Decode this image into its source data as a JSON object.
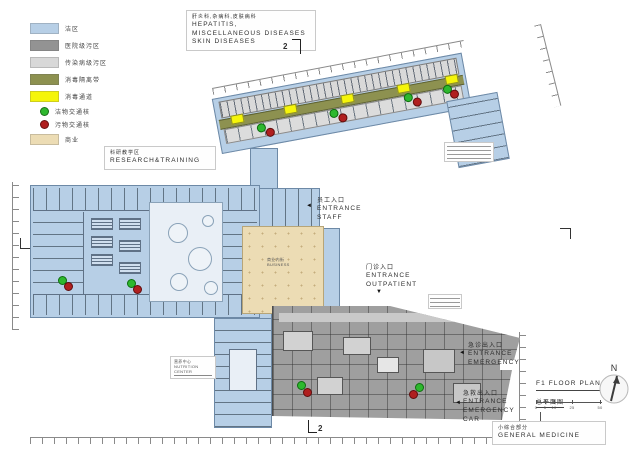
{
  "colors": {
    "clean_area": "#b7cfe6",
    "hospital_contaminated": "#939393",
    "infectious_contaminated": "#d8d8d8",
    "disinfection_belt": "#8d9150",
    "disinfection_passage": "#f5f50a",
    "clean_traffic_node": "#2eb82e",
    "dirty_traffic_node": "#b01f1f",
    "commerce": "#ecdcb4"
  },
  "legend": {
    "items": [
      {
        "label": "洁区",
        "color": "#b7cfe6",
        "shape": "swatch"
      },
      {
        "label": "医院级污区",
        "color": "#939393",
        "shape": "swatch"
      },
      {
        "label": "传染病级污区",
        "color": "#d8d8d8",
        "shape": "swatch"
      },
      {
        "label": "消毒隔离带",
        "color": "#8d9150",
        "shape": "swatch"
      },
      {
        "label": "消毒通道",
        "color": "#f5f50a",
        "shape": "swatch"
      },
      {
        "label": "洁物交通核",
        "color": "#2eb82e",
        "shape": "dot"
      },
      {
        "label": "污物交通核",
        "color": "#b01f1f",
        "shape": "dot"
      },
      {
        "label": "商业",
        "color": "#ecdcb4",
        "shape": "swatch"
      }
    ]
  },
  "title_block": {
    "zh": "肝炎科,杂病科,皮肤病科",
    "en1": "HEPATITIS,",
    "en2": "MISCELLANEOUS DISEASES",
    "en3": "SKIN DISEASES"
  },
  "labels": {
    "research": {
      "zh": "科研教学区",
      "en": "RESEARCH&TRAINING"
    },
    "nutrition": {
      "zh": "营养中心",
      "en1": "NUTRITION",
      "en2": "CENTER"
    },
    "commerce": {
      "zh": "商业内街",
      "en": "BUSINESS"
    },
    "general": {
      "zh": "小综合部分",
      "en": "GENERAL MEDICINE"
    }
  },
  "entrances": {
    "staff": {
      "zh": "员工入口",
      "en1": "ENTRANCE",
      "en2": "STAFF",
      "arrow": "◄"
    },
    "outpatient": {
      "zh": "门诊入口",
      "en1": "ENTRANCE",
      "en2": "OUTPATIENT",
      "arrow": "▼"
    },
    "emergency": {
      "zh": "急诊出入口",
      "en1": "ENTRANCE",
      "en2": "EMERGENCY",
      "arrow": "◄"
    },
    "emergency_car": {
      "zh": "急救出入口",
      "en1": "ENTRANCE",
      "en2": "EMERGENCY",
      "en3": "CAR",
      "arrow": "◄"
    }
  },
  "plan_info": {
    "title": "F1 FLOOR PLAN",
    "subtitle": "总平面图",
    "scale_labels": [
      "0",
      "5",
      "10",
      "25",
      "50"
    ]
  },
  "compass": {
    "north": "N"
  },
  "section_markers": {
    "top": "2",
    "bottom": "2"
  }
}
